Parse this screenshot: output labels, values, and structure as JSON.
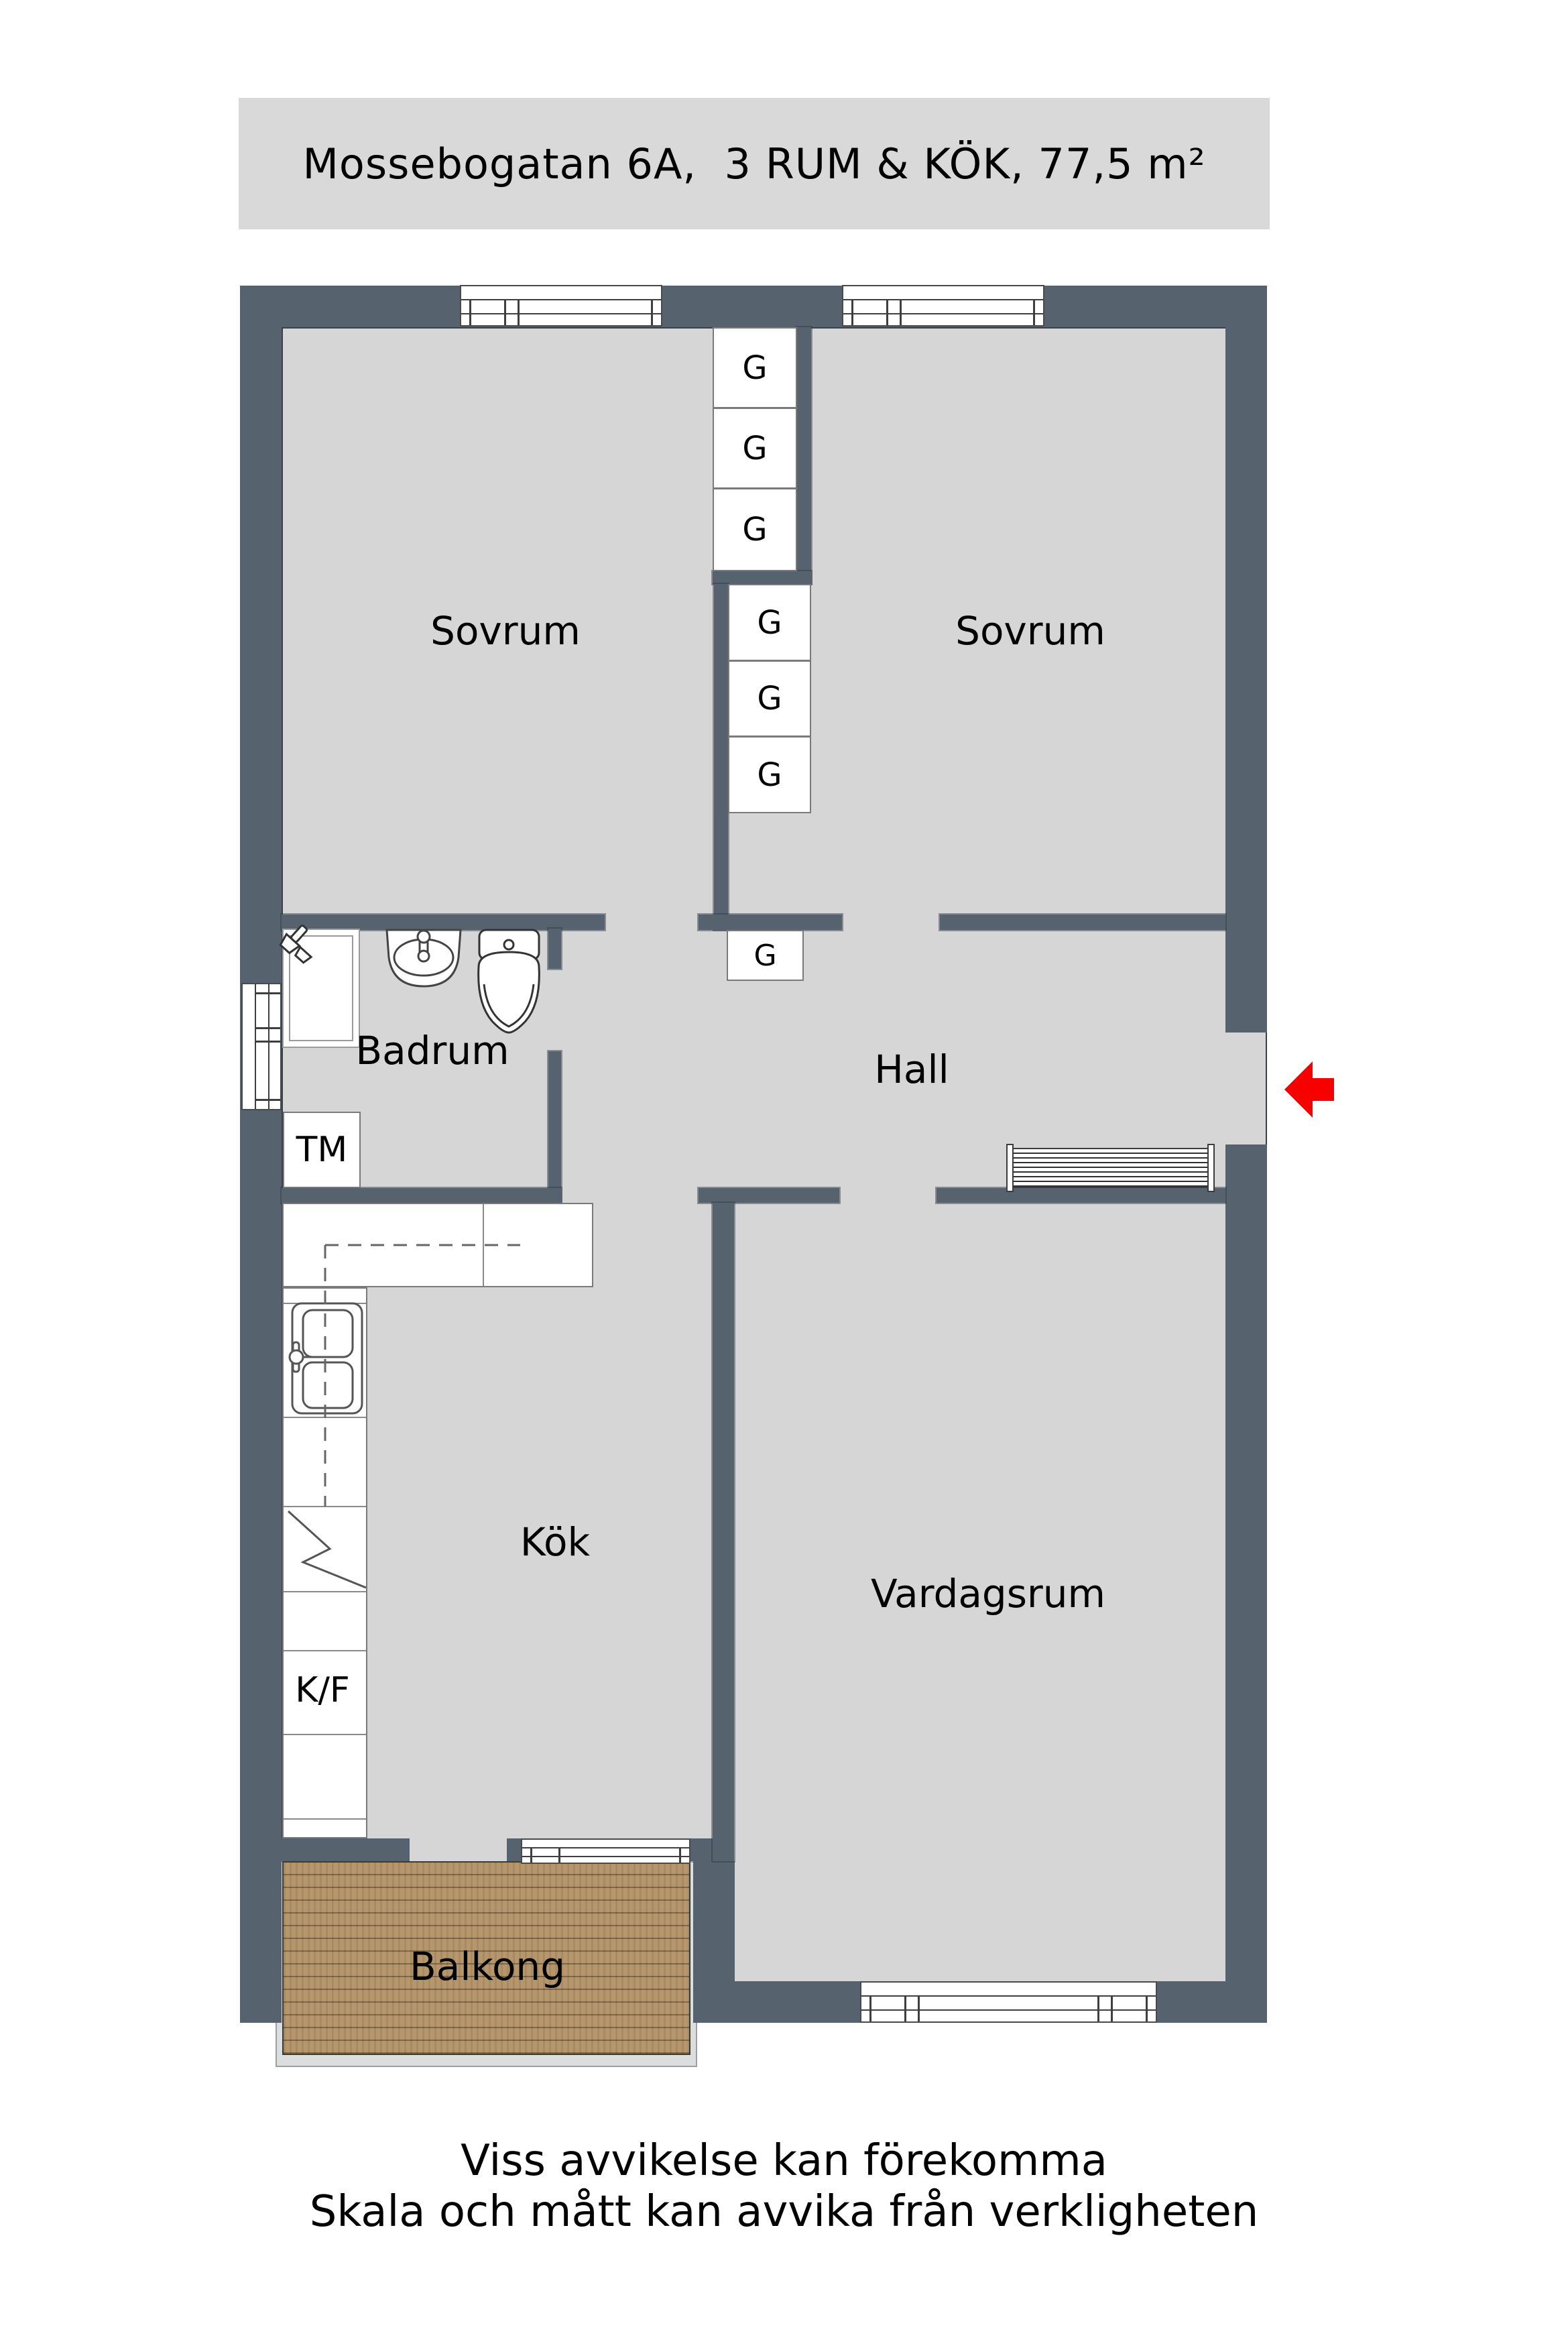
{
  "title": "Mossebogatan 6A,  3 RUM & KÖK, 77,5 m²",
  "rooms": {
    "sovrum_left": "Sovrum",
    "sovrum_right": "Sovrum",
    "badrum": "Badrum",
    "hall": "Hall",
    "kok": "Kök",
    "vardagsrum": "Vardagsrum",
    "balkong": "Balkong"
  },
  "labels": {
    "garderob": "G",
    "washing_machine": "TM",
    "fridge_freezer": "K/F"
  },
  "disclaimer": {
    "line1": "Viss avvikelse kan förekomma",
    "line2": "Skala och mått kan avvika från verkligheten"
  },
  "icons": {
    "entry_arrow": "red-arrow-left-entrance"
  },
  "colors": {
    "wall": "#56636f",
    "floor": "#d6d6d6",
    "banner_bg": "#d9d9d9",
    "fixture": "#ffffff",
    "balcony_wood": "#b29267",
    "balcony_rim": "#dcdddd",
    "entry_arrow": "#f60000",
    "outline": "#39424c",
    "text": "#000000"
  }
}
